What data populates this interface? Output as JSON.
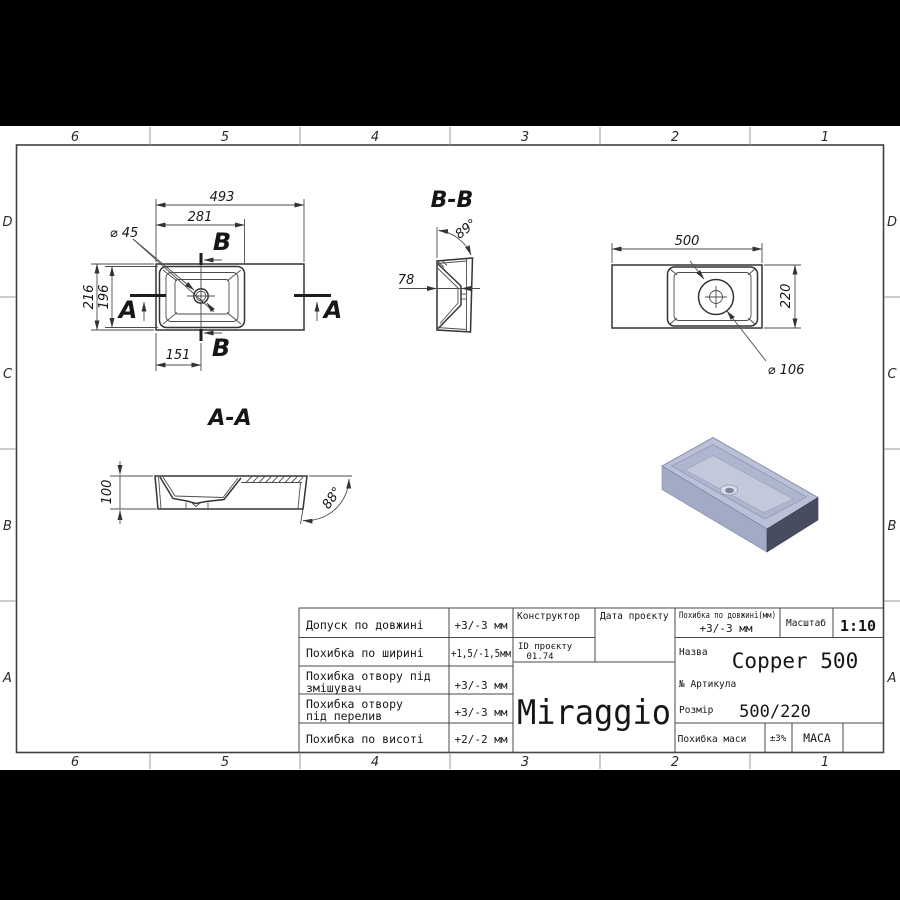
{
  "frame": {
    "cols": [
      "6",
      "5",
      "4",
      "3",
      "2",
      "1"
    ],
    "rows": [
      "D",
      "C",
      "B",
      "A"
    ]
  },
  "views": {
    "plan_left": {
      "dim_width_total": "493",
      "dim_width_bowl": "281",
      "dim_hole": "⌀ 45",
      "dim_height_total": "216",
      "dim_height_bowl": "196",
      "dim_offset": "151",
      "section_b_label": "B",
      "section_a_label": "A"
    },
    "section_bb": {
      "title": "B-B",
      "dim_angle": "89°",
      "dim_depth": "78"
    },
    "plan_right": {
      "dim_width": "500",
      "dim_height": "220",
      "dim_hole": "⌀ 106"
    },
    "section_aa": {
      "title": "A-A",
      "dim_height": "100",
      "dim_angle": "88°"
    }
  },
  "title_block": {
    "tolerances": [
      {
        "label": "Допуск по довжині",
        "value": "+3/-3 мм"
      },
      {
        "label": "Похибка по ширині",
        "value": "+1,5/-1,5мм"
      },
      {
        "label": "Похибка отвору під",
        "label2": "змішувач",
        "value": "+3/-3 мм"
      },
      {
        "label": "Похибка отвору",
        "label2": "під перелив",
        "value": "+3/-3 мм"
      },
      {
        "label": "Похибка по висоті",
        "value": "+2/-2 мм"
      }
    ],
    "designer_label": "Конструктор",
    "project_id_label": "ID проєкту",
    "project_id": "01.74",
    "date_label": "Дата проєкту",
    "brand": "Miraggio",
    "length_tolerance_label": "Похибка по довжині(мм)",
    "length_tolerance": "+3/-3 мм",
    "scale_label": "Масштаб",
    "scale": "1:10",
    "name_label": "Назва",
    "name": "Copper 500",
    "article_label": "№ Артикула",
    "size_label": "Розмір",
    "size": "500/220",
    "mass_tolerance_label": "Похибка маси",
    "mass_tolerance": "±3%",
    "mass_label": "МАСА"
  },
  "colors": {
    "render_top": "#b9c0d8",
    "render_bowl": "#aeb5cf",
    "render_floor": "#c3c8db",
    "render_front": "#a3aac6",
    "render_side": "#474c5e",
    "render_drain": "#7d849e",
    "render_drain_rim": "#dcdfe9"
  }
}
